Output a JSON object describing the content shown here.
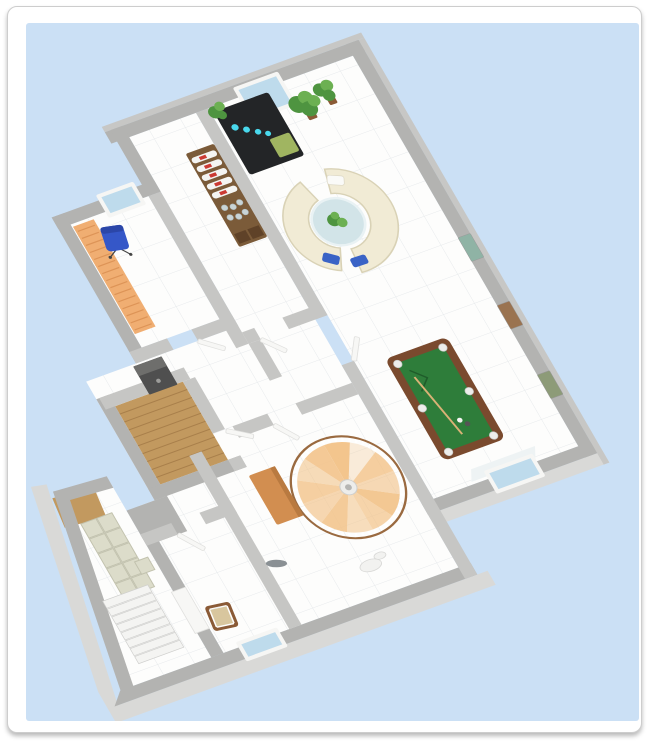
{
  "scene": {
    "description": "3D floor plan render of one house level, rotated on a light blue background",
    "background_color": "#cbe0f5",
    "card_background": "#ffffff",
    "card_border_color": "#cdcdcd",
    "wall_color": "#b3b3b1",
    "interior_wall_color": "#c6c6c4",
    "wall_rim_color": "#c7c7c5",
    "apron_color": "#d9d9d7",
    "floor_color": "#fdfdfc",
    "floor_grid_color": "#e7eaec",
    "wood_floor_color": "#c2995f",
    "wood_plank_line_color": "#a87f4b",
    "window_glass_color": "#bedbec",
    "window_frame_color": "#f6f6f4",
    "window_sill_color": "#eef3f4",
    "door_leaf_color": "#f7f7f5",
    "rotation_deg": -20
  },
  "furniture": {
    "curved_sofas": {
      "label": "two curved sofas",
      "body_color": "#f1ebd5",
      "edge_color": "#d9d2b6",
      "blue_pillow_color": "#3a63c6",
      "white_pillow_color": "#fafaf8"
    },
    "round_table": {
      "label": "round glass table",
      "glass_color": "#d2e4e8",
      "rim_color": "#e9f2f4"
    },
    "plants": {
      "label": "potted plants",
      "leaf_color": "#4e9440",
      "leaf_color_light": "#6cb052",
      "pot_color": "#8a5a36"
    },
    "bar_cabinet": {
      "label": "black cabinet with lights",
      "body_color": "#232527",
      "light_dot_color": "#49d8ec",
      "panel_color": "#a8bd64"
    },
    "bottle_shelf": {
      "label": "bottle and glass shelf",
      "frame_color": "#7b5b39",
      "bottle_color": "#f4f4f2",
      "label_color": "#cc3a33",
      "glass_color": "#c9d4d6",
      "base_color": "#5f4228"
    },
    "office_chair": {
      "label": "blue office chair",
      "seat_color": "#3557c8",
      "back_color": "#2b46a8"
    },
    "wall_bench": {
      "label": "slatted wooden bench",
      "wood_color": "#f0ae72",
      "stripe_color": "#dd9457"
    },
    "safe": {
      "label": "gray safe",
      "body_color": "#4f4f4f",
      "top_color": "#6e6e6c"
    },
    "pool_table": {
      "label": "billiard table",
      "frame_color": "#7a4a2e",
      "felt_color": "#2e7d3a",
      "pocket_color": "#ededeb",
      "cue_color": "#d9b276"
    },
    "spiral_staircase": {
      "label": "wooden spiral staircase",
      "wood_color": "#f2c287",
      "rail_color": "#9a6a40",
      "baluster_color": "#ffffff",
      "pole_color": "#b5b5b3"
    },
    "desk": {
      "label": "wooden desk",
      "top_color": "#d28e50",
      "edge_color": "#b97a40"
    },
    "wooden_chair": {
      "label": "small wooden chair",
      "frame_color": "#8a5a36",
      "seat_color": "#d8c69e"
    },
    "straight_stairs": {
      "label": "straight staircase",
      "tread_color": "#f4f4f2",
      "edge_color": "#cfcfcd"
    },
    "cube_shelf": {
      "label": "cube storage shelf",
      "cube_color": "#dcdcca",
      "line_color": "#c2c2ae"
    },
    "sink": {
      "label": "white basin",
      "color": "#f2f2f0"
    },
    "floor_item": {
      "label": "small gray object",
      "color": "#8a9094"
    }
  },
  "lounge": {
    "artworks": [
      "#8fb3a5",
      "#9a7350",
      "#8d9b78"
    ]
  }
}
